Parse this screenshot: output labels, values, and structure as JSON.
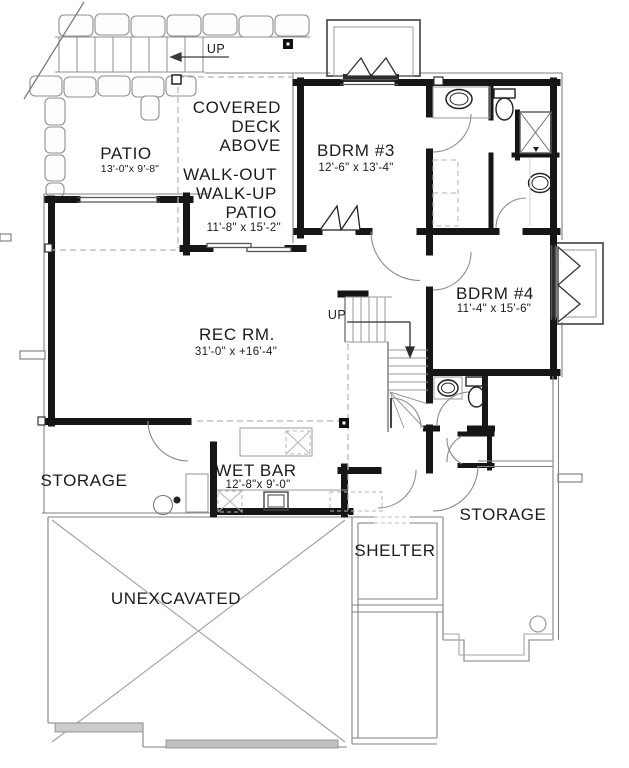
{
  "plan": {
    "entry": {
      "up_label": "UP"
    },
    "stairs": {
      "up_label": "UP"
    },
    "rooms": {
      "patio": {
        "name": "PATIO",
        "dims": "13'-0\"x 9'-8\""
      },
      "covered_deck": {
        "line1": "COVERED",
        "line2": "DECK",
        "line3": "ABOVE"
      },
      "walkout_patio": {
        "line1": "WALK-OUT",
        "line2": "WALK-UP",
        "line3": "PATIO",
        "dims": "11'-8\" x 15'-2\""
      },
      "bdrm3": {
        "name": "BDRM #3",
        "dims": "12'-6\" x 13'-4\""
      },
      "bdrm4": {
        "name": "BDRM #4",
        "dims": "11'-4\" x 15'-6\""
      },
      "rec_room": {
        "name": "REC RM.",
        "dims": "31'-0\" x +16'-4\""
      },
      "wet_bar": {
        "name": "WET BAR",
        "dims": "12'-8\"x 9'-0\""
      },
      "storage_left": {
        "name": "STORAGE"
      },
      "storage_right": {
        "name": "STORAGE"
      },
      "shelter": {
        "name": "SHELTER"
      },
      "unexcavated": {
        "name": "UNEXCAVATED"
      }
    },
    "colors": {
      "wall": "#1b1b1b",
      "thin": "#7a7a7a",
      "light": "#a0a0a0",
      "text": "#1c1c1c"
    }
  }
}
